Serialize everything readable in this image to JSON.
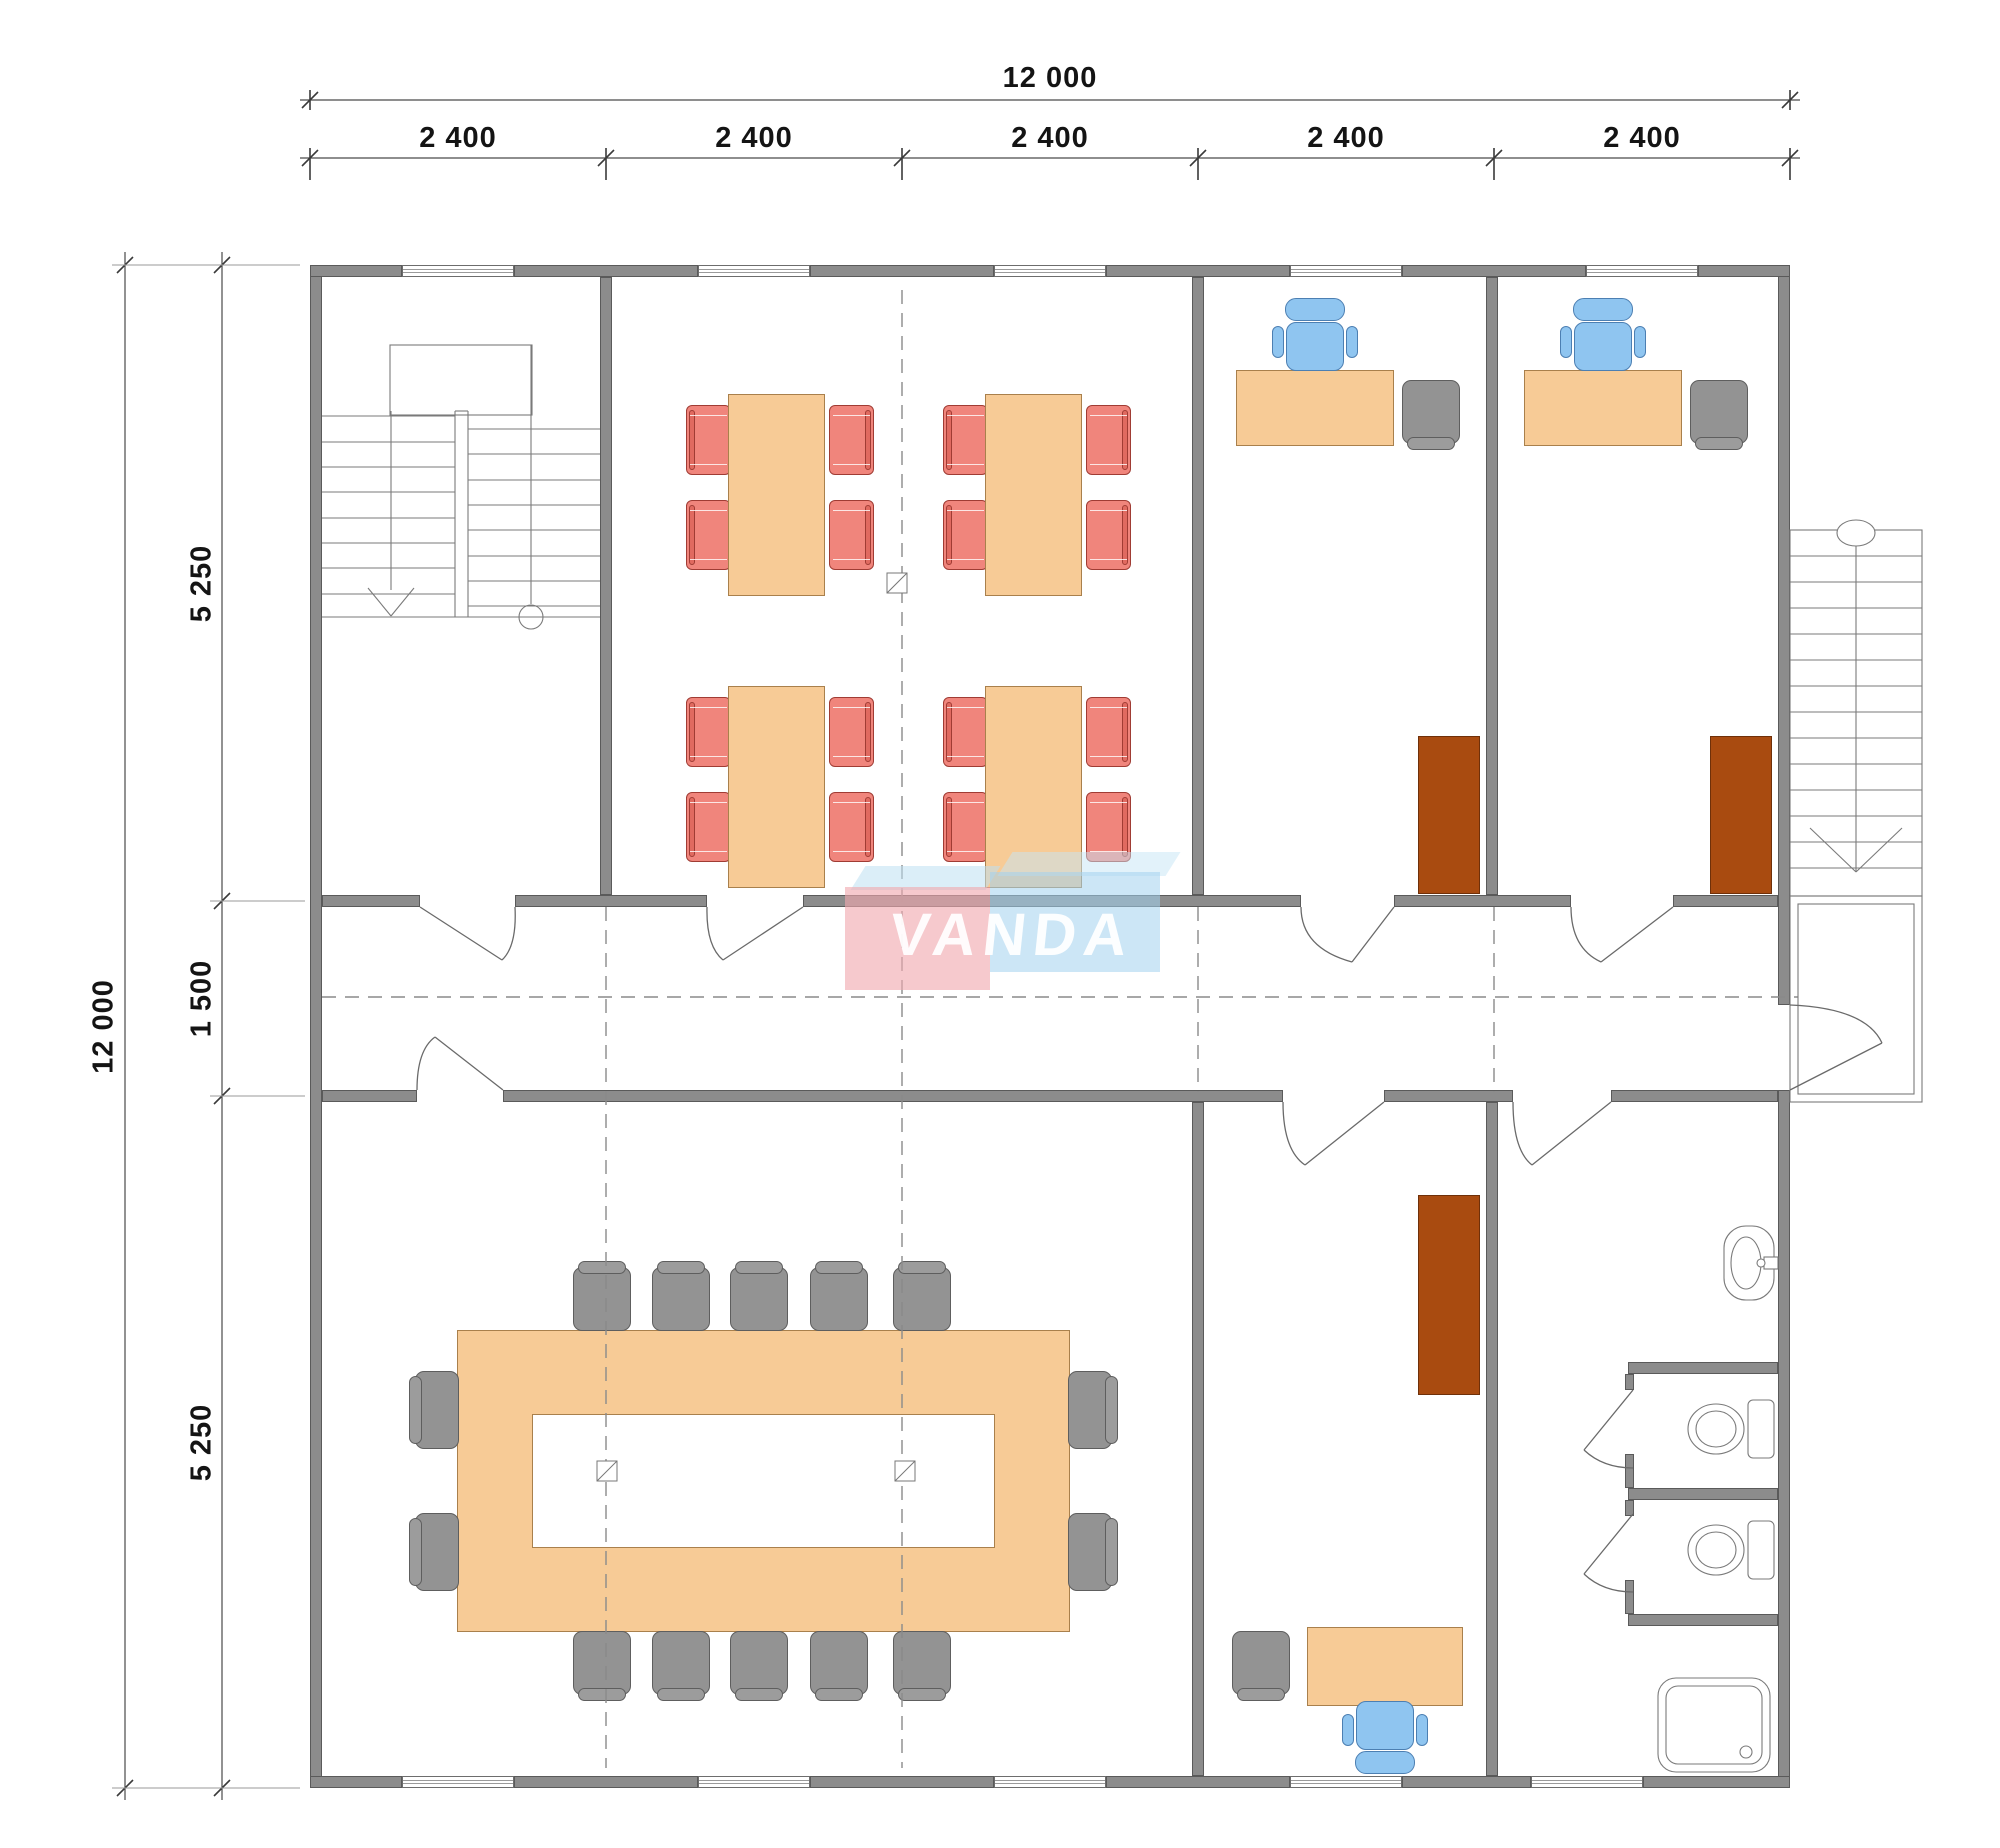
{
  "drawing": {
    "type": "architectural floor plan",
    "description": "Single-storey office module 12000 x 12000 mm with central corridor, canteen, offices, conference room, sanitary block and two staircases",
    "watermark_text": "VANDA"
  },
  "dimensions": {
    "top_total": "12 000",
    "top_segments": [
      "2 400",
      "2 400",
      "2 400",
      "2 400",
      "2 400"
    ],
    "left_total": "12 000",
    "left_segments": [
      "5 250",
      "1 500",
      "5 250"
    ]
  },
  "colors": {
    "wall_fill": "#8C8C8C",
    "wall_stroke": "#5A5A5A",
    "furniture_wood": "#F7CB96",
    "chair_red": "#F0857C",
    "chair_blue": "#8FC5F0",
    "chair_gray": "#939393",
    "cabinet_brown": "#A94B10",
    "watermark_pink": "rgba(241,168,174,0.62)",
    "watermark_blue": "rgba(163,209,238,0.55)",
    "line_gray": "#6A6A6A"
  },
  "rooms": {
    "stairwell": {
      "features": [
        "two-flight internal stair",
        "down arrow",
        "start circle"
      ]
    },
    "canteen": {
      "tables": 4,
      "chairs_per_table": 4,
      "chair_color": "red"
    },
    "office_top_1": {
      "desk": 1,
      "task_chair": "blue",
      "visitor_chair": "gray",
      "cabinet": 1
    },
    "office_top_2": {
      "desk": 1,
      "task_chair": "blue",
      "visitor_chair": "gray",
      "cabinet": 1
    },
    "conference_room": {
      "table": "hollow rectangle",
      "chairs": 14,
      "columns": 2
    },
    "office_bottom": {
      "desk": 1,
      "task_chair": "blue",
      "visitor_chair": "gray",
      "cabinet": 1
    },
    "bathroom": {
      "sink": 1,
      "toilets": 2,
      "shower": 1,
      "stalls": 2
    },
    "external_stair": {
      "treads": 13,
      "landing": 1
    }
  }
}
